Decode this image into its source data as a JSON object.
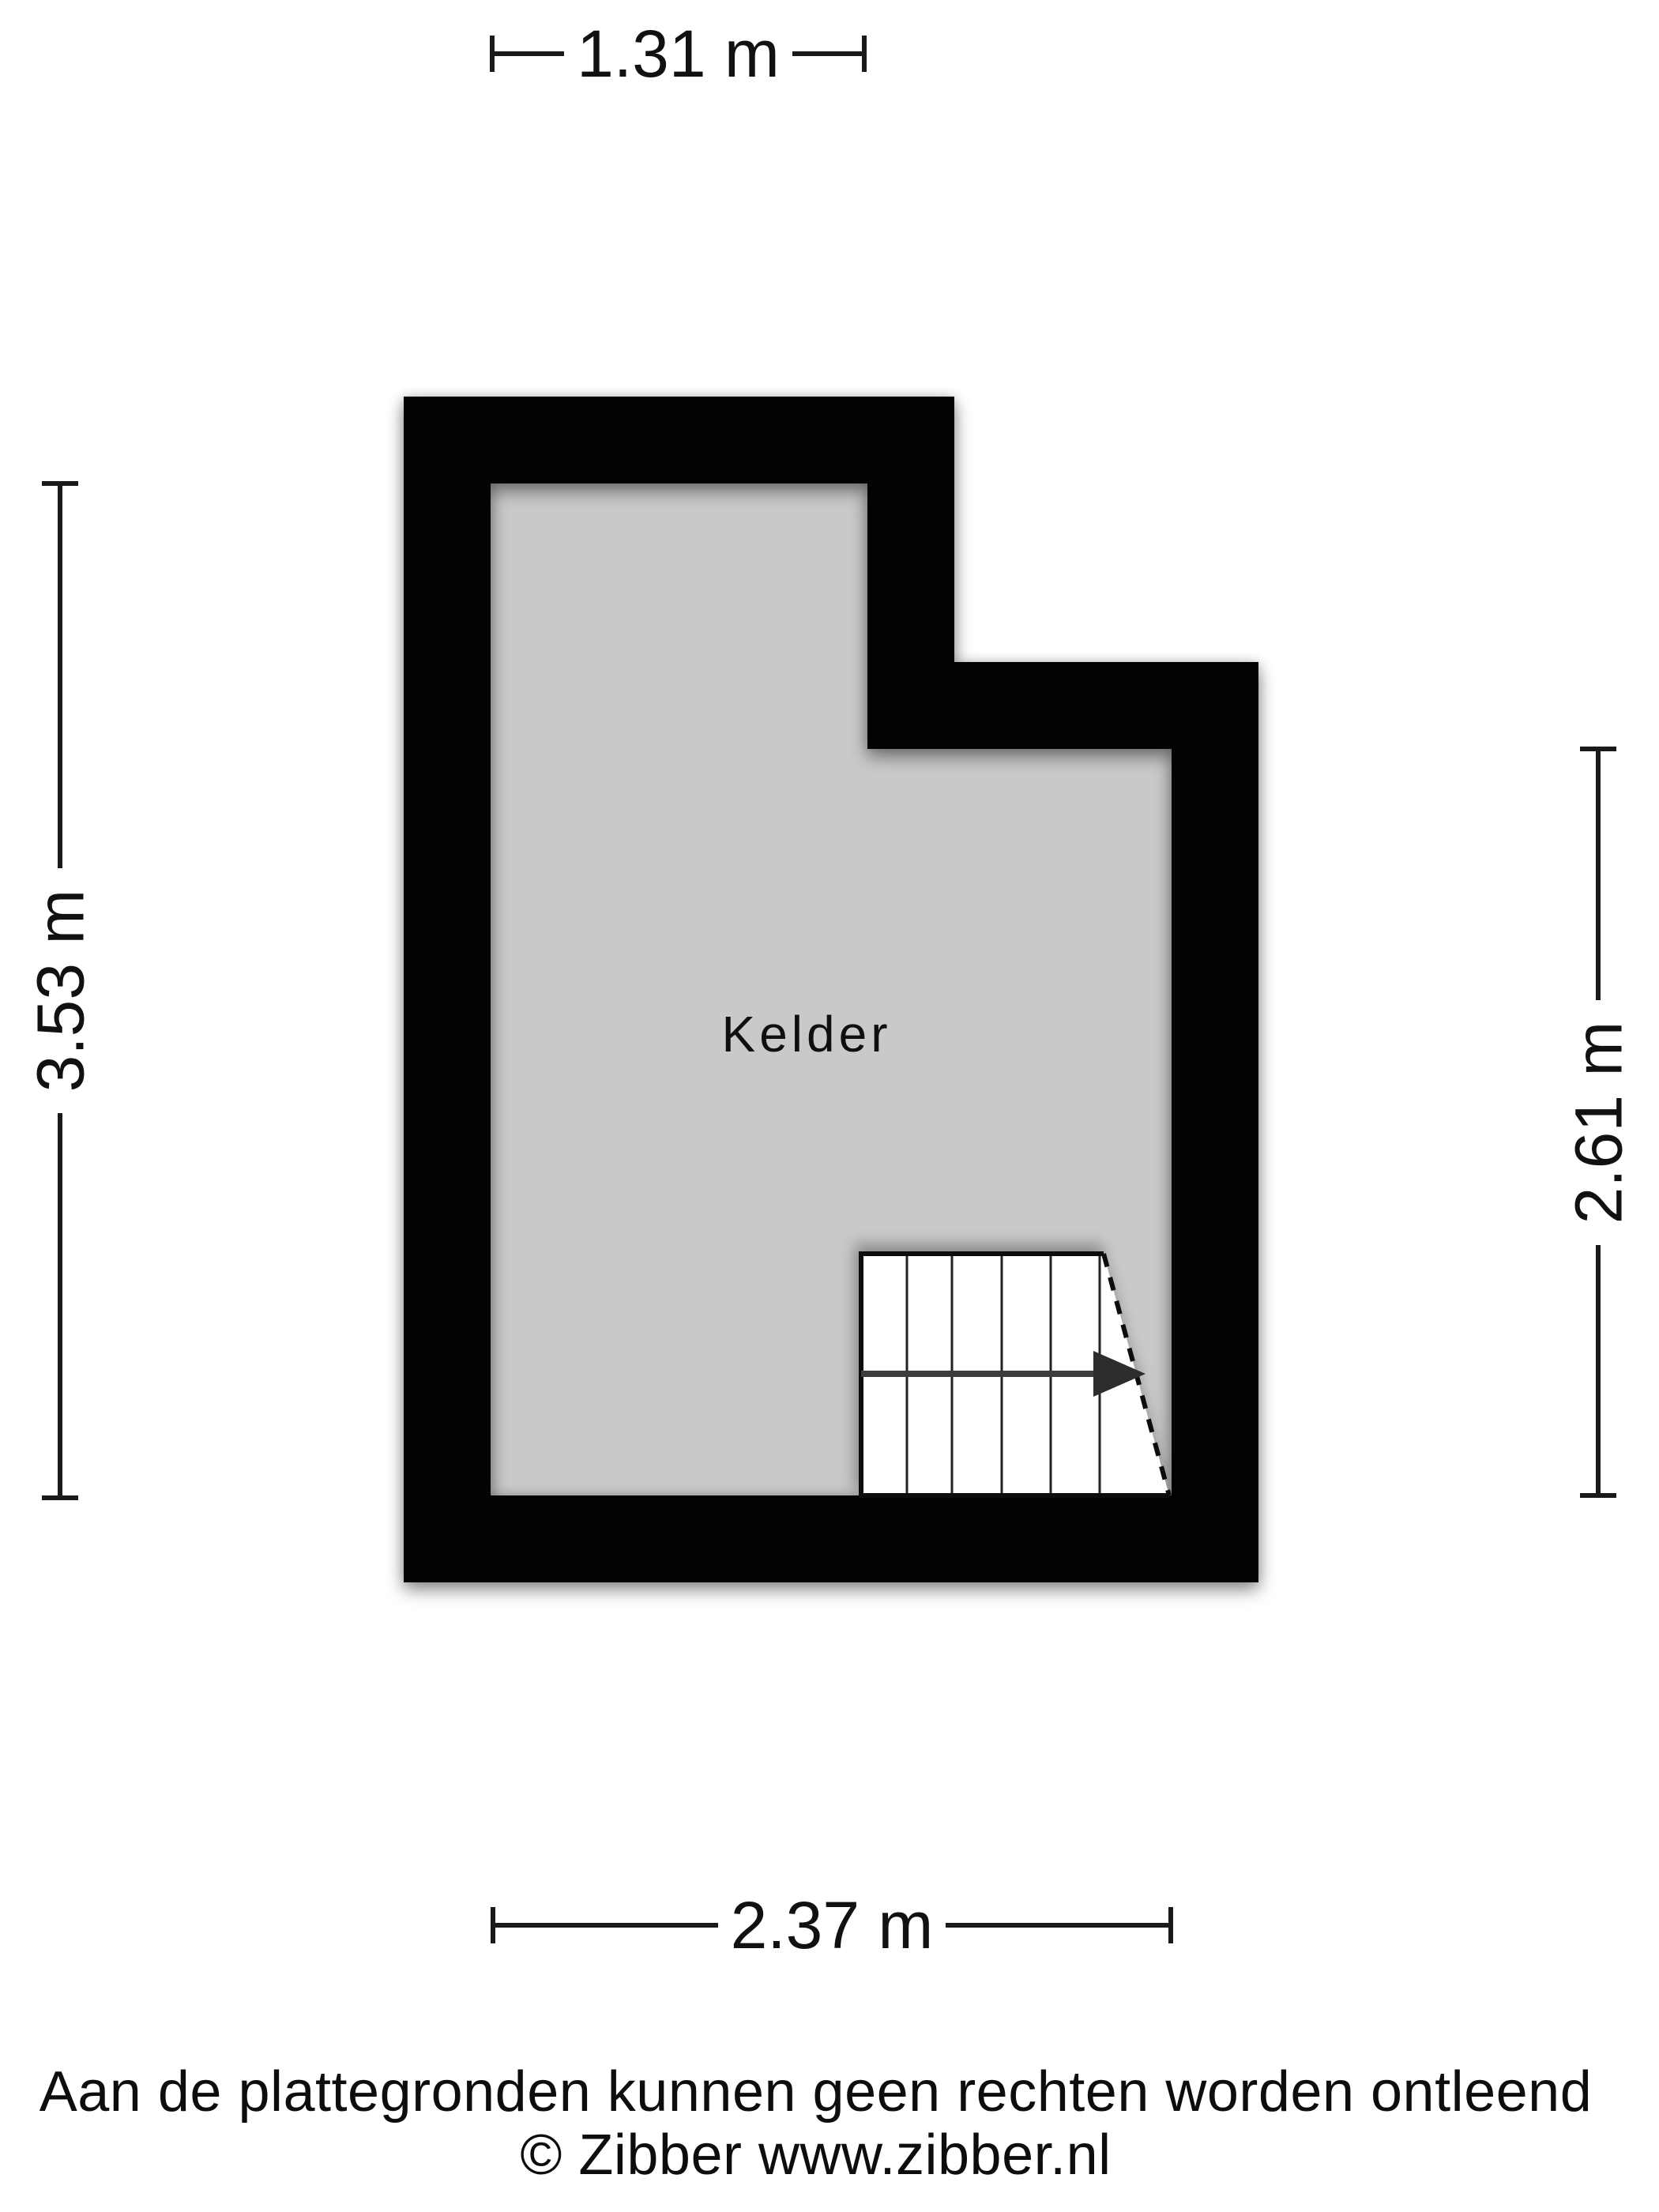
{
  "floorplan": {
    "room_label": "Kelder",
    "dimensions": {
      "top": "1.31 m",
      "left": "3.53 m",
      "right": "2.61 m",
      "bottom": "2.37 m"
    },
    "stairs": {
      "tread_count": 6,
      "direction": "right"
    }
  },
  "footer": {
    "disclaimer": "Aan de plattegronden kunnen geen rechten worden ontleend",
    "copyright": "© Zibber www.zibber.nl"
  },
  "colors": {
    "wall": "#030303",
    "room_fill": "#c8c9ca",
    "stairs_fill": "#ffffff",
    "dimension_line": "#1a1a1a",
    "stairs_arrow": "#3d3d3d",
    "background": "#ffffff"
  }
}
